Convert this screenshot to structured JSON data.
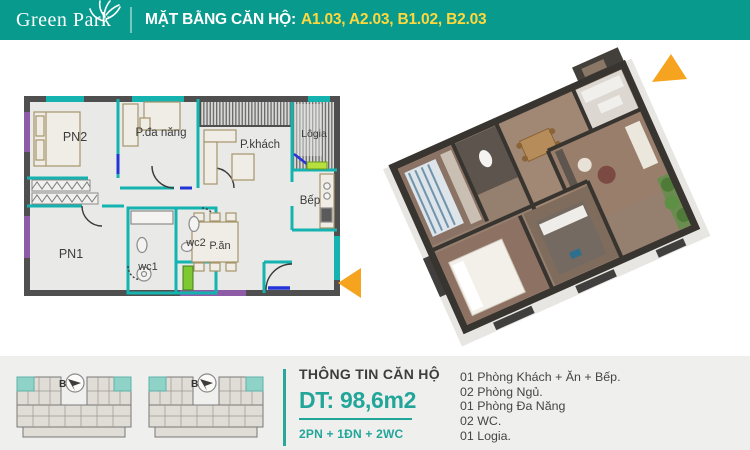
{
  "header": {
    "logo_name": "Green Park",
    "title_prefix": "MẶT BẰNG CĂN HỘ:",
    "unit_codes": "A1.03, A2.03, B1.02, B2.03"
  },
  "floor_plan_2d": {
    "rooms": {
      "pn2": "PN2",
      "p_da_nang": "P.đa năng",
      "p_khach": "P.khách",
      "logia": "Lôgia",
      "bep": "Bếp",
      "pn1": "PN1",
      "wc1": "wc1",
      "wc2": "wc2",
      "p_an": "P.ăn"
    }
  },
  "key_plans": [
    {
      "label": "B"
    },
    {
      "label": "B"
    }
  ],
  "info": {
    "heading": "THÔNG TIN CĂN HỘ",
    "area": "DT: 98,6m2",
    "composition": "2PN + 1ĐN + 2WC",
    "features": [
      "01 Phòng Khách + Ăn + Bếp.",
      "02 Phòng Ngủ.",
      "01 Phòng Đa Năng",
      "02 WC.",
      "01 Logia."
    ]
  },
  "colors": {
    "header_teal": "#079a8d",
    "accent_teal": "#23a69a",
    "code_yellow": "#ffd83d",
    "arrow_orange": "#f6a41f",
    "highlight_unit": "#8ed2c8"
  }
}
